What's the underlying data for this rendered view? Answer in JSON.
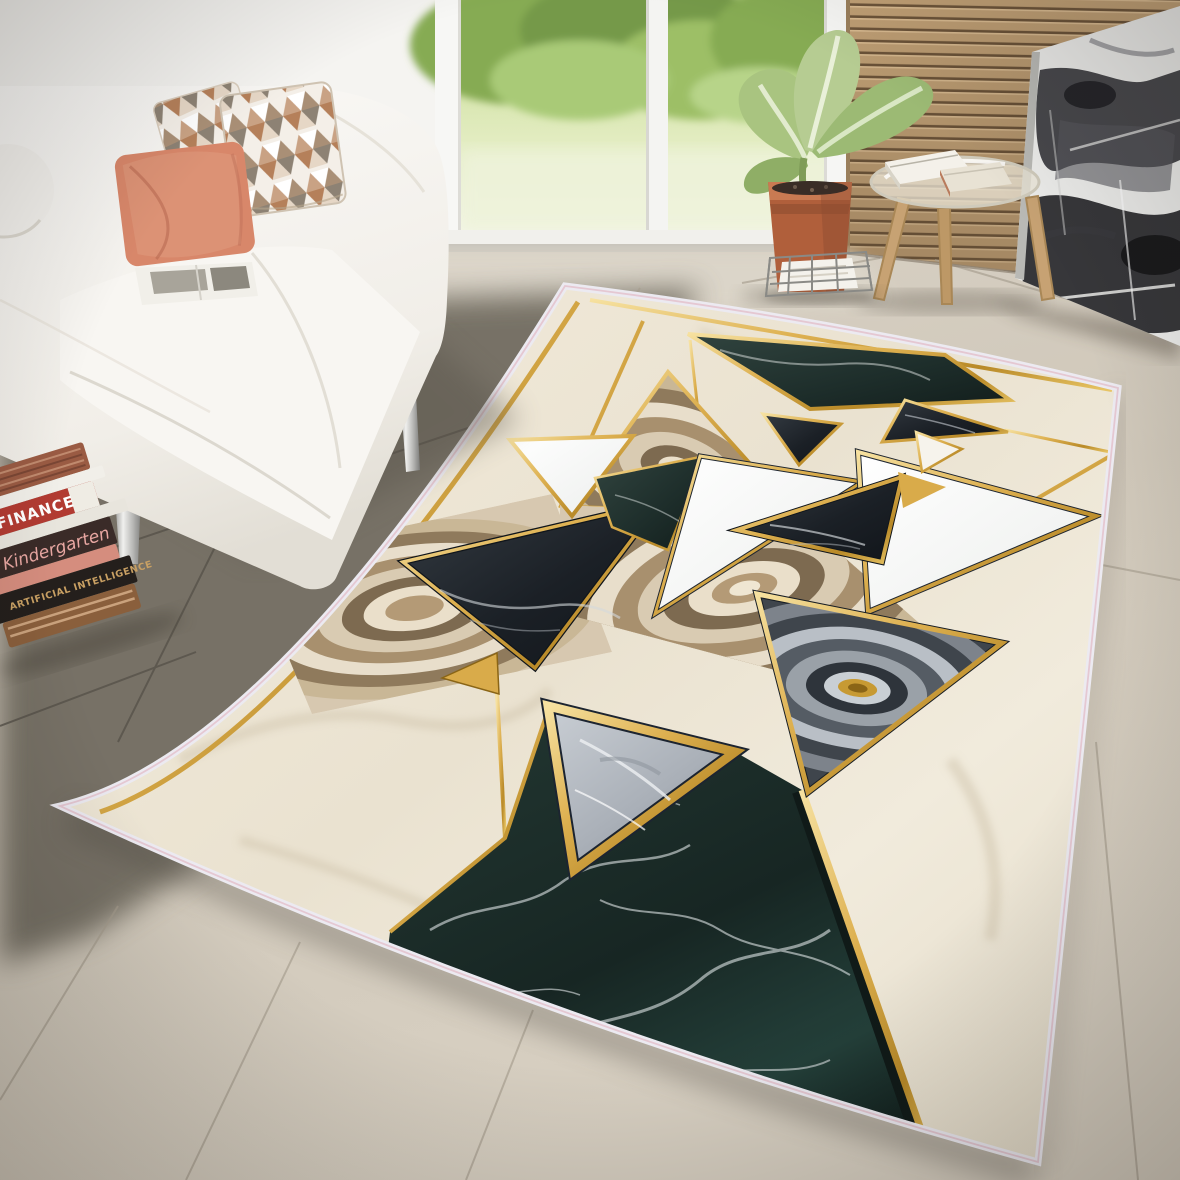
{
  "scene_title": "Marble geometric rug in living room",
  "books_floor": [
    {
      "spine_text": "FINANCE"
    },
    {
      "spine_text": "Kindergarten"
    },
    {
      "spine_text": "ARTIFICIAL INTELLIGENCE"
    }
  ],
  "palette": {
    "gold": "#d9ab4a",
    "gold_light": "#f3dc92",
    "gold_dark": "#9c741f",
    "rug_cream": "#efe8d8",
    "swirl_beige": "#b59a77",
    "black_marble": "#1c2127",
    "green_marble": "#20312e",
    "gray_marble": "#b8bec6",
    "white_marble": "#fafaf8",
    "selvedge": "#eceaf1",
    "selvedge_pink": "#e3bfca",
    "floor_light": "#cfc7ba",
    "floor_dark": "#6f6a5f",
    "wall": "#f3f2ef",
    "slat_wood": "#c2a176",
    "slat_gap": "#6e553a",
    "terracotta": "#b05f3b",
    "plant_green": "#a9c480",
    "sofa_white": "#f7f5f1",
    "pillow_salmon": "#d8876a",
    "pillow_tan": "#b5805a",
    "chrome": "#b9b9b7",
    "canvas_dark": "#2b2b30",
    "garden_green": "#86ab52"
  }
}
